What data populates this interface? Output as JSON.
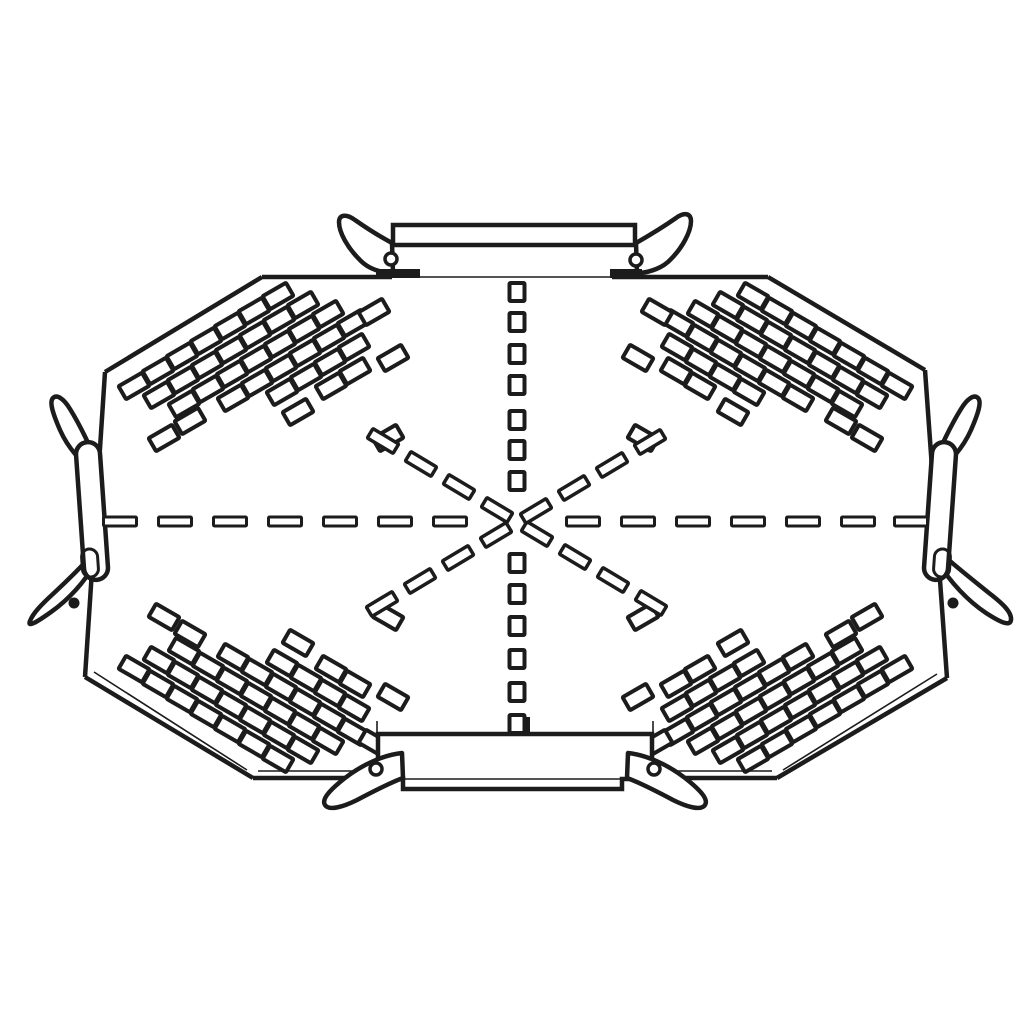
{
  "meta": {
    "subject": "perforated-cable-tray-cross-plate-technical-drawing",
    "style": "monochrome line art",
    "colors": {
      "ink": "#1c1c1c",
      "paper": "#ffffff"
    }
  },
  "canvas": {
    "width": 1030,
    "height": 1030
  },
  "plate": {
    "outline": [
      [
        262,
        277
      ],
      [
        768,
        277
      ],
      [
        925,
        370
      ],
      [
        947,
        678
      ],
      [
        777,
        778
      ],
      [
        253,
        778
      ],
      [
        85,
        677
      ],
      [
        105,
        372
      ]
    ],
    "edges": [
      {
        "name": "top-edge-left",
        "x1": 262,
        "y1": 277,
        "x2": 392,
        "y2": 277,
        "w": 4.5
      },
      {
        "name": "top-edge-behind-coupler",
        "x1": 392,
        "y1": 277,
        "x2": 612,
        "y2": 277,
        "w": 1.6
      },
      {
        "name": "top-edge-right",
        "x1": 612,
        "y1": 277,
        "x2": 768,
        "y2": 277,
        "w": 4.5
      },
      {
        "name": "top-right-chamfer",
        "x1": 768,
        "y1": 277,
        "x2": 925,
        "y2": 370,
        "w": 4.5
      },
      {
        "name": "right-edge",
        "x1": 925,
        "y1": 370,
        "x2": 947,
        "y2": 678,
        "w": 4.5
      },
      {
        "name": "bottom-right-chamfer",
        "x1": 947,
        "y1": 678,
        "x2": 777,
        "y2": 778,
        "w": 4.5
      },
      {
        "name": "bottom-edge",
        "x1": 777,
        "y1": 778,
        "x2": 253,
        "y2": 778,
        "w": 4.5
      },
      {
        "name": "bottom-left-chamfer",
        "x1": 253,
        "y1": 778,
        "x2": 85,
        "y2": 677,
        "w": 4.5
      },
      {
        "name": "left-edge",
        "x1": 85,
        "y1": 677,
        "x2": 105,
        "y2": 372,
        "w": 4.5
      },
      {
        "name": "top-left-chamfer",
        "x1": 105,
        "y1": 372,
        "x2": 262,
        "y2": 277,
        "w": 4.5
      }
    ],
    "inner_thickness_lines": [
      {
        "name": "bottom-inner",
        "x1": 258,
        "y1": 771,
        "x2": 772,
        "y2": 771,
        "w": 1.6
      },
      {
        "name": "bottom-left-chamfer-inner",
        "x1": 94,
        "y1": 672,
        "x2": 247,
        "y2": 770,
        "w": 1.6
      },
      {
        "name": "bottom-right-chamfer-inner",
        "x1": 937,
        "y1": 674,
        "x2": 783,
        "y2": 770,
        "w": 1.6
      }
    ]
  },
  "perforation": {
    "slot": {
      "w": 27,
      "h": 15,
      "rx": 1,
      "stroke": 4
    },
    "fields": {
      "top-left": {
        "origin": [
          278,
          296
        ],
        "chain_step": [
          25,
          9
        ],
        "row_step": [
          -24,
          15
        ],
        "rot": -30,
        "chain_counts": [
          4,
          5,
          6,
          6,
          5,
          4,
          3
        ],
        "outliers": [
          [
            374,
            312
          ],
          [
            393,
            358
          ],
          [
            298,
            412
          ],
          [
            388,
            438
          ],
          [
            190,
            421
          ],
          [
            164,
            438
          ]
        ]
      },
      "top-right": {
        "origin": [
          753,
          296
        ],
        "chain_step": [
          -25,
          9
        ],
        "row_step": [
          24,
          15
        ],
        "rot": 30,
        "chain_counts": [
          4,
          5,
          6,
          6,
          5,
          4,
          3
        ],
        "outliers": [
          [
            657,
            312
          ],
          [
            638,
            358
          ],
          [
            733,
            412
          ],
          [
            643,
            438
          ],
          [
            841,
            421
          ],
          [
            867,
            438
          ]
        ]
      },
      "bottom-left": {
        "origin": [
          278,
          759
        ],
        "chain_step": [
          25,
          -9
        ],
        "row_step": [
          -24,
          -15
        ],
        "rot": 30,
        "chain_counts": [
          4,
          5,
          6,
          6,
          5,
          4,
          3
        ],
        "outliers": [
          [
            374,
            743
          ],
          [
            393,
            697
          ],
          [
            298,
            643
          ],
          [
            388,
            617
          ],
          [
            190,
            634
          ],
          [
            164,
            617
          ]
        ]
      },
      "bottom-right": {
        "origin": [
          753,
          759
        ],
        "chain_step": [
          -25,
          -9
        ],
        "row_step": [
          24,
          -15
        ],
        "rot": -30,
        "chain_counts": [
          4,
          5,
          6,
          6,
          5,
          4,
          3
        ],
        "outliers": [
          [
            657,
            743
          ],
          [
            638,
            697
          ],
          [
            733,
            643
          ],
          [
            643,
            617
          ],
          [
            841,
            634
          ],
          [
            867,
            617
          ]
        ]
      }
    }
  },
  "centerlines": {
    "horizontal_dashes": {
      "y": 521.5,
      "w": 33,
      "h": 9,
      "stroke": 3,
      "xs": [
        120,
        175,
        230,
        285,
        340,
        395,
        450,
        583,
        638,
        693,
        748,
        803,
        858,
        911
      ]
    },
    "vertical_squares": {
      "x": 517,
      "w": 15,
      "h": 18,
      "stroke": 4,
      "ys": [
        292,
        322,
        354,
        385,
        420,
        450,
        481,
        563,
        594,
        626,
        659,
        692,
        724
      ]
    },
    "diagonal_arms": {
      "dash": {
        "w": 30,
        "h": 11,
        "stroke": 3.5
      },
      "arms": [
        {
          "name": "upper-left-arm",
          "start": [
            497,
            510
          ],
          "step": [
            -38,
            -23
          ],
          "count": 4,
          "rot": 31
        },
        {
          "name": "lower-right-arm",
          "start": [
            537,
            534
          ],
          "step": [
            38,
            23
          ],
          "count": 4,
          "rot": 31
        },
        {
          "name": "upper-right-arm",
          "start": [
            536,
            511
          ],
          "step": [
            38,
            -23
          ],
          "count": 4,
          "rot": -31
        },
        {
          "name": "lower-left-arm",
          "start": [
            496,
            535
          ],
          "step": [
            -38,
            23
          ],
          "count": 4,
          "rot": -31
        }
      ]
    }
  },
  "couplers": {
    "top": {
      "rect": {
        "x": 393,
        "y": 225,
        "w": 242,
        "h": 20,
        "stroke": 4.5
      },
      "stems": [
        [
          391,
          245,
          391,
          273
        ],
        [
          636,
          245,
          636,
          273
        ]
      ],
      "wings": [
        "M392,243 C379,236 365,227 355,220 C347,214 339,214 339,222 C339,233 348,248 359,259 C367,268 379,272 390,273 L393,273 Z",
        "M636,243 C650,235 666,225 676,218 C684,212 691,213 691,221 C691,232 682,248 671,259 C663,268 650,272 640,273 L637,273 Z"
      ],
      "foot_wedges": [
        [
          376,
          269,
          44,
          9
        ],
        [
          610,
          269,
          32,
          9
        ]
      ],
      "rivets": [
        [
          391,
          259,
          6
        ],
        [
          636,
          260,
          6
        ]
      ]
    },
    "bottom": {
      "tab": {
        "x": 510,
        "y": 719,
        "w": 18,
        "h": 16,
        "stroke": 4
      },
      "stems": [
        [
          377,
          721,
          377,
          733
        ],
        [
          653,
          721,
          653,
          733
        ]
      ],
      "body_path": "M378,734 H652 V779 H622 V789 H403 V779 H378 Z",
      "body_stroke": 4.5,
      "step_line": [
        403,
        779,
        622,
        779
      ],
      "wings": [
        "M402,753 C383,755 362,765 345,778 C331,789 321,799 325,805 C329,811 343,807 357,800 C374,791 392,782 403,778 Z",
        "M628,753 C647,755 668,765 685,778 C699,789 709,799 705,805 C701,811 687,807 673,800 C656,791 638,782 627,778 Z"
      ],
      "rivets": [
        [
          376,
          769,
          6
        ],
        [
          654,
          769,
          6
        ]
      ]
    },
    "left": {
      "wing_top": "M96,472 C82,464 68,448 60,430 C53,414 49,402 53,398 C57,394 64,399 70,409 C80,425 91,448 98,466 Z",
      "wing_bottom": "M95,563 C85,582 68,600 51,612 C37,622 27,628 30,621 C33,613 42,604 54,593 C68,580 82,566 93,554 Z",
      "capsule": {
        "x": 80,
        "y": 442,
        "w": 24,
        "h": 138,
        "rx": 12,
        "rot": -4,
        "cx": 92,
        "cy": 511,
        "stroke": 4.5
      },
      "cap_inner": {
        "x": 82,
        "y": 549,
        "w": 16,
        "h": 28,
        "rx": 8,
        "rot": -4,
        "cx": 90,
        "cy": 563,
        "stroke": 3
      },
      "rivet_dot": [
        74,
        603,
        5.5
      ]
    },
    "right": {
      "wing_top": "M935,472 C949,464 963,448 971,430 C978,414 982,402 978,398 C974,394 967,399 961,409 C951,425 940,448 933,466 Z",
      "wing_bottom": "M938,562 C950,582 968,601 986,613 C1000,622 1010,627 1011,620 C1012,612 1002,603 989,593 C973,580 955,566 942,554 Z",
      "capsule": {
        "x": 928,
        "y": 442,
        "w": 24,
        "h": 138,
        "rx": 12,
        "rot": 4,
        "cx": 940,
        "cy": 511,
        "stroke": 4.5
      },
      "cap_inner": {
        "x": 934,
        "y": 549,
        "w": 16,
        "h": 28,
        "rx": 8,
        "rot": 4,
        "cx": 942,
        "cy": 563,
        "stroke": 3
      },
      "rivet_dot": [
        953,
        603,
        5.5
      ]
    }
  }
}
